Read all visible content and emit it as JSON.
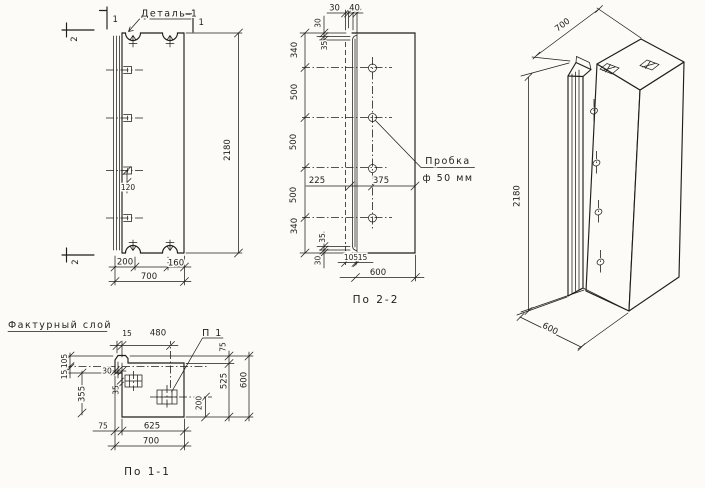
{
  "front_view": {
    "detail_callout": "Деталь 1",
    "section_mark_1": "1",
    "section_mark_2": "2",
    "dims": {
      "height": "2180",
      "hook_spacing": "120",
      "bottom_left": "200",
      "bottom_right": "160",
      "width_total": "700"
    }
  },
  "section_2_2": {
    "caption": "По 2-2",
    "plug_callout": {
      "line1": "Пробка",
      "line2": "ф 50 мм"
    },
    "dims": {
      "top_30": "30",
      "top_40": "40",
      "top_lip_30": "30",
      "top_lip_35": "35",
      "left_chain": [
        "340",
        "500",
        "500",
        "500",
        "340"
      ],
      "hole_left": "225",
      "hole_right": "375",
      "bottom_lip_35": "35",
      "bottom_lip_30": "30",
      "bottom_105": "105",
      "bottom_15": "15",
      "depth_total": "600"
    }
  },
  "section_1_1": {
    "caption": "По 1-1",
    "facing_layer_callout": "Фактурный слой",
    "embed_callout": "П 1",
    "dims": {
      "top_15": "15",
      "top_480": "480",
      "left_105": "105",
      "left_15": "15",
      "left_355": "355",
      "step_30": "30",
      "step_35": "35",
      "right_75": "75",
      "right_525": "525",
      "right_600": "600",
      "right_200": "200",
      "bottom_75": "75",
      "bottom_625": "625",
      "bottom_700": "700"
    }
  },
  "isometric_view": {
    "dims": {
      "width": "700",
      "height": "2180",
      "depth": "600"
    }
  }
}
